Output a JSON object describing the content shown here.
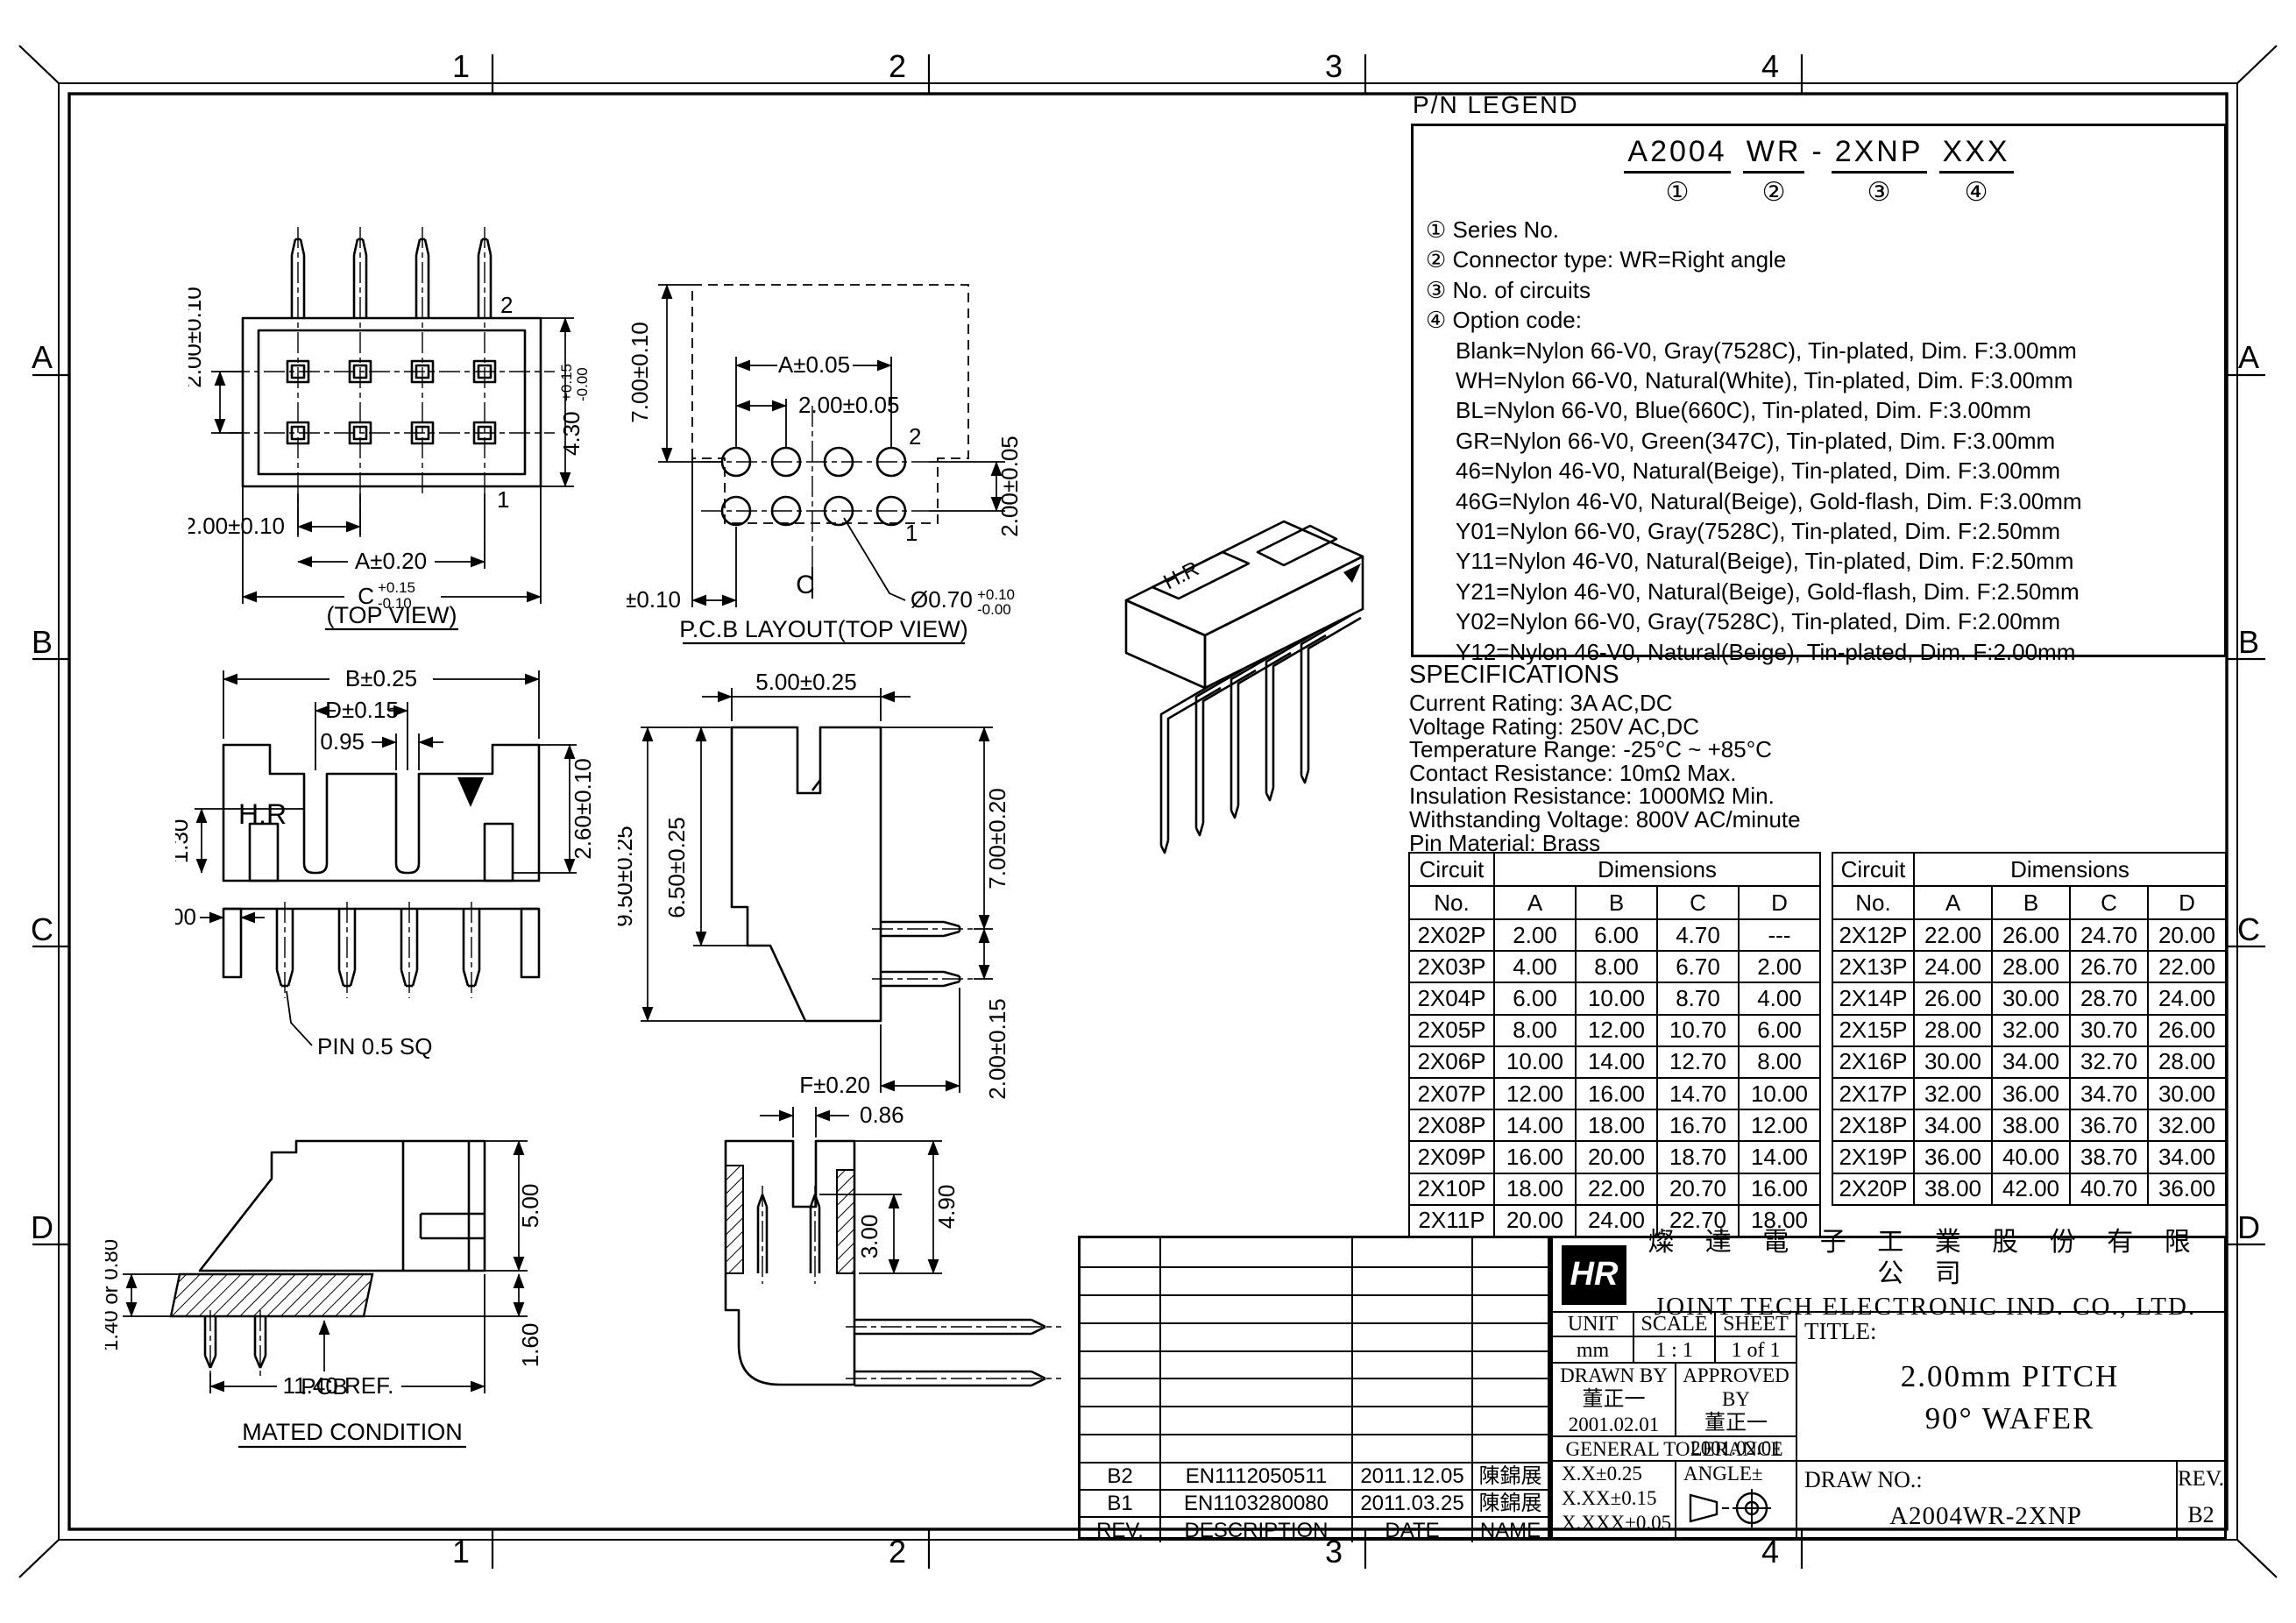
{
  "frame": {
    "zone_numbers": [
      "1",
      "2",
      "3",
      "4"
    ],
    "zone_letters": [
      "A",
      "B",
      "C",
      "D"
    ]
  },
  "legend": {
    "title": "P/N LEGEND",
    "part": [
      {
        "text": "A2004",
        "mark": "①"
      },
      {
        "text": "WR",
        "mark": "②"
      },
      {
        "text": "-",
        "mark": ""
      },
      {
        "text": "2XNP",
        "mark": "③"
      },
      {
        "text": "XXX",
        "mark": "④"
      }
    ],
    "items": [
      "① Series No.",
      "② Connector type: WR=Right angle",
      "③ No. of circuits",
      "④ Option code:"
    ],
    "options": [
      "Blank=Nylon 66-V0, Gray(7528C), Tin-plated, Dim. F:3.00mm",
      "WH=Nylon 66-V0, Natural(White), Tin-plated, Dim. F:3.00mm",
      "BL=Nylon 66-V0, Blue(660C), Tin-plated, Dim. F:3.00mm",
      "GR=Nylon 66-V0, Green(347C), Tin-plated, Dim. F:3.00mm",
      "46=Nylon 46-V0, Natural(Beige), Tin-plated, Dim. F:3.00mm",
      "46G=Nylon 46-V0, Natural(Beige), Gold-flash, Dim. F:3.00mm",
      "Y01=Nylon 66-V0, Gray(7528C), Tin-plated, Dim. F:2.50mm",
      "Y11=Nylon 46-V0, Natural(Beige), Tin-plated, Dim. F:2.50mm",
      "Y21=Nylon 46-V0, Natural(Beige), Gold-flash, Dim. F:2.50mm",
      "Y02=Nylon 66-V0, Gray(7528C), Tin-plated, Dim. F:2.00mm",
      "Y12=Nylon 46-V0, Natural(Beige), Tin-plated, Dim. F:2.00mm"
    ]
  },
  "specifications": {
    "title": "SPECIFICATIONS",
    "lines": [
      "Current Rating: 3A AC,DC",
      "Voltage Rating: 250V AC,DC",
      "Temperature Range: -25°C ~ +85°C",
      "Contact Resistance: 10mΩ Max.",
      "Insulation Resistance: 1000MΩ Min.",
      "Withstanding Voltage: 800V AC/minute",
      "Pin Material: Brass"
    ]
  },
  "tables": {
    "headers": {
      "circuit": "Circuit",
      "no": "No.",
      "dimensions": "Dimensions",
      "a": "A",
      "b": "B",
      "c": "C",
      "d": "D"
    },
    "left": {
      "rows": [
        [
          "2X02P",
          "2.00",
          "6.00",
          "4.70",
          "---"
        ],
        [
          "2X03P",
          "4.00",
          "8.00",
          "6.70",
          "2.00"
        ],
        [
          "2X04P",
          "6.00",
          "10.00",
          "8.70",
          "4.00"
        ],
        [
          "2X05P",
          "8.00",
          "12.00",
          "10.70",
          "6.00"
        ],
        [
          "2X06P",
          "10.00",
          "14.00",
          "12.70",
          "8.00"
        ],
        [
          "2X07P",
          "12.00",
          "16.00",
          "14.70",
          "10.00"
        ],
        [
          "2X08P",
          "14.00",
          "18.00",
          "16.70",
          "12.00"
        ],
        [
          "2X09P",
          "16.00",
          "20.00",
          "18.70",
          "14.00"
        ],
        [
          "2X10P",
          "18.00",
          "22.00",
          "20.70",
          "16.00"
        ],
        [
          "2X11P",
          "20.00",
          "24.00",
          "22.70",
          "18.00"
        ]
      ]
    },
    "right": {
      "rows": [
        [
          "2X12P",
          "22.00",
          "26.00",
          "24.70",
          "20.00"
        ],
        [
          "2X13P",
          "24.00",
          "28.00",
          "26.70",
          "22.00"
        ],
        [
          "2X14P",
          "26.00",
          "30.00",
          "28.70",
          "24.00"
        ],
        [
          "2X15P",
          "28.00",
          "32.00",
          "30.70",
          "26.00"
        ],
        [
          "2X16P",
          "30.00",
          "34.00",
          "32.70",
          "28.00"
        ],
        [
          "2X17P",
          "32.00",
          "36.00",
          "34.70",
          "30.00"
        ],
        [
          "2X18P",
          "34.00",
          "38.00",
          "36.70",
          "32.00"
        ],
        [
          "2X19P",
          "36.00",
          "40.00",
          "38.70",
          "34.00"
        ],
        [
          "2X20P",
          "38.00",
          "42.00",
          "40.70",
          "36.00"
        ]
      ]
    }
  },
  "revision_table": {
    "headers": [
      "REV.",
      "DESCRIPTION",
      "DATE",
      "NAME"
    ],
    "rows": [
      [
        "B2",
        "EN1112050511",
        "2011.12.05",
        "陳錦展"
      ],
      [
        "B1",
        "EN1103280080",
        "2011.03.25",
        "陳錦展"
      ]
    ]
  },
  "title_block": {
    "logo_text": "HR",
    "company_cn": "燦 達 電 子 工 業 股 份 有 限 公 司",
    "company_en": "JOINT TECH ELECTRONIC IND. CO., LTD.",
    "unit_label": "UNIT",
    "unit_value": "mm",
    "scale_label": "SCALE",
    "scale_value": "1 : 1",
    "sheet_label": "SHEET",
    "sheet_value": "1 of 1",
    "drawn_by_label": "DRAWN BY",
    "drawn_by_name": "董正一",
    "drawn_date": "2001.02.01",
    "approved_by_label": "APPROVED BY",
    "approved_by_name": "董正一",
    "approved_date": "2001.02.01",
    "general_tolerance_label": "GENERAL TOLERANCE",
    "tolerances": [
      "X.X±0.25",
      "X.XX±0.15",
      "X.XXX±0.05"
    ],
    "angle_label": "ANGLE±",
    "title_label": "TITLE:",
    "title_line1": "2.00mm PITCH",
    "title_line2": "90° WAFER",
    "draw_no_label": "DRAW NO.:",
    "draw_no": "A2004WR-2XNP",
    "rev_label": "REV.",
    "rev_value": "B2"
  },
  "drawings": {
    "top_view": {
      "caption": "(TOP VIEW)",
      "pitch_v": "2.00±0.10",
      "pitch_h": "2.00±0.10",
      "a": "A±0.20",
      "c": "C",
      "c_tp": "+0.15",
      "c_tm": "-0.10",
      "h": "4.30",
      "h_tp": "+0.15",
      "h_tm": "-0.00",
      "pin2": "2",
      "pin1": "1"
    },
    "pcb_layout": {
      "caption": "P.C.B LAYOUT(TOP VIEW)",
      "height": "7.00±0.10",
      "a": "A±0.05",
      "pitch": "2.00±0.05",
      "row": "2.00±0.05",
      "offset": "2.00±0.10",
      "hole": "Ø0.70",
      "hole_tp": "+0.10",
      "hole_tm": "-0.00",
      "centerline": "C",
      "pin2": "2",
      "pin1": "1"
    },
    "front_view": {
      "b": "B±0.25",
      "d": "D±0.15",
      "w095": "0.95",
      "h26": "2.60±0.10",
      "h13": "1.30",
      "w100": "1.00",
      "brand": "H.R",
      "pin_note": "PIN 0.5 SQ"
    },
    "side_view": {
      "w5": "5.00±0.25",
      "h95": "9.50±0.25",
      "h65": "6.50±0.25",
      "h7": "7.00±0.20",
      "p2": "2.00±0.15",
      "f": "F±0.20"
    },
    "section_view": {
      "w086": "0.86",
      "h3": "3.00",
      "h49": "4.90"
    },
    "mated": {
      "caption": "MATED CONDITION",
      "h14": "1.40 or 0.80",
      "h5": "5.00",
      "h16": "1.60",
      "pcb": "PCB",
      "ref": "11.40 REF."
    },
    "iso_view": {
      "brand": "H.R"
    }
  }
}
